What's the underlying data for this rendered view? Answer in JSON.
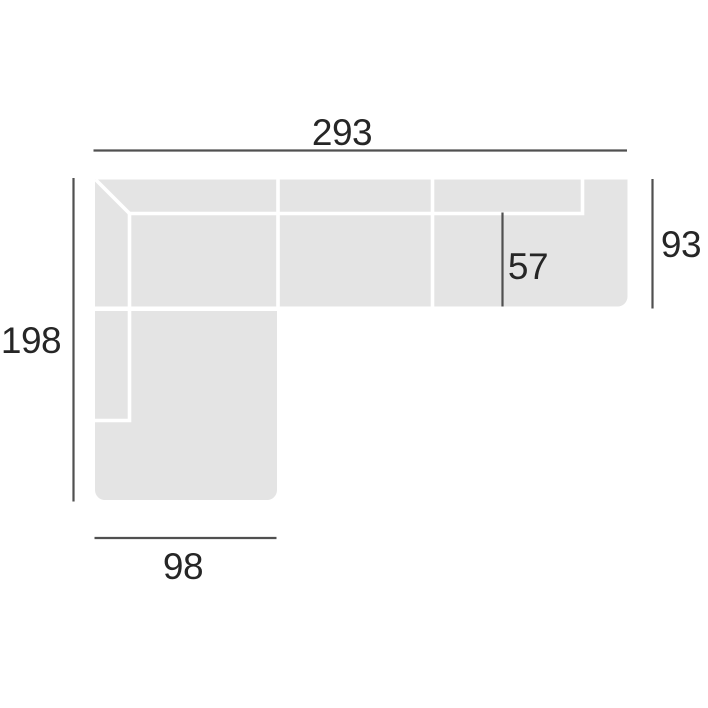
{
  "diagram": {
    "labels": {
      "total_width": "293",
      "left_depth": "198",
      "right_depth": "93",
      "seat_depth": "57",
      "chaise_width": "98"
    },
    "colors": {
      "background": "#ffffff",
      "sofa_fill": "#e4e4e4",
      "seam": "#ffffff",
      "dimension_line": "#505050",
      "label_text": "#262626"
    }
  }
}
